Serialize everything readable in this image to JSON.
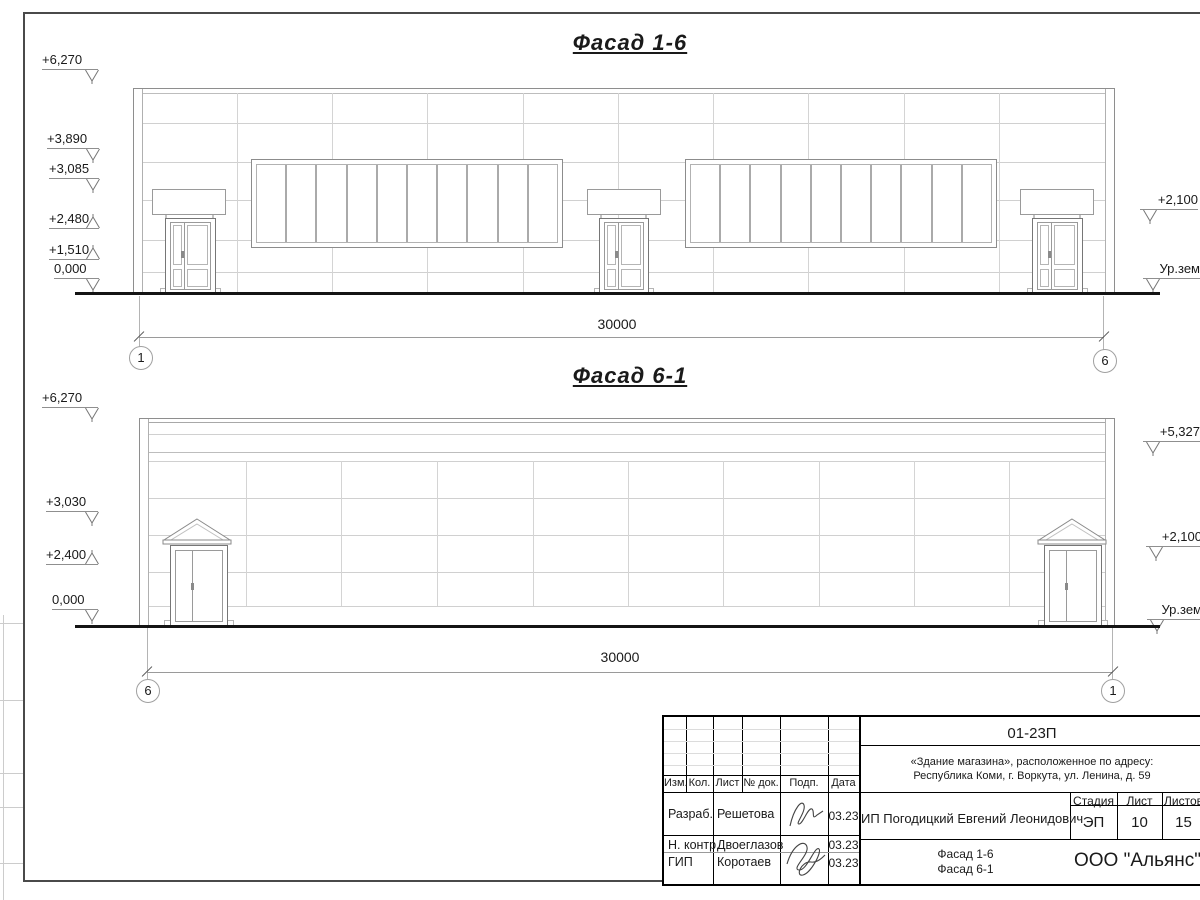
{
  "facade_top": {
    "title": "Фасад 1-6",
    "levels_left": [
      "+6,270",
      "+3,890",
      "+3,085",
      "+2,480",
      "+1,510",
      "0,000"
    ],
    "levels_right": [
      "+2,100",
      "Ур.зем"
    ],
    "dimension": "30000",
    "axis_left": "1",
    "axis_right": "6"
  },
  "facade_bottom": {
    "title": "Фасад 6-1",
    "levels_left": [
      "+6,270",
      "+3,030",
      "+2,400",
      "0,000"
    ],
    "levels_right": [
      "+5,327",
      "+2,100",
      "Ур.зем"
    ],
    "dimension": "30000",
    "axis_left": "6",
    "axis_right": "1"
  },
  "title_block": {
    "doc_code": "01-23П",
    "address_line1": "«Здание магазина», расположенное по адресу:",
    "address_line2": "Республика Коми, г. Воркута, ул. Ленина, д. 59",
    "client": "ИП Погодицкий Евгений Леонидович",
    "columns": [
      "Изм.",
      "Кол.",
      "Лист",
      "№ док.",
      "Подп.",
      "Дата"
    ],
    "stage_label": "Стадия",
    "sheet_label": "Лист",
    "sheets_label": "Листов",
    "stage_value": "ЭП",
    "sheet_value": "10",
    "sheets_value": "15",
    "sheet_title_line1": "Фасад 1-6",
    "sheet_title_line2": "Фасад 6-1",
    "company": "ООО \"Альянс\"",
    "rows": [
      {
        "role": "Разраб.",
        "name": "Решетова",
        "date": "03.23"
      },
      {
        "role": "Н. контр.",
        "name": "Двоеглазов",
        "date": "03.23"
      },
      {
        "role": "ГИП",
        "name": "Коротаев",
        "date": "03.23"
      }
    ]
  },
  "colors": {
    "ink": "#1a1a1a",
    "line": "#8e8e8e"
  }
}
